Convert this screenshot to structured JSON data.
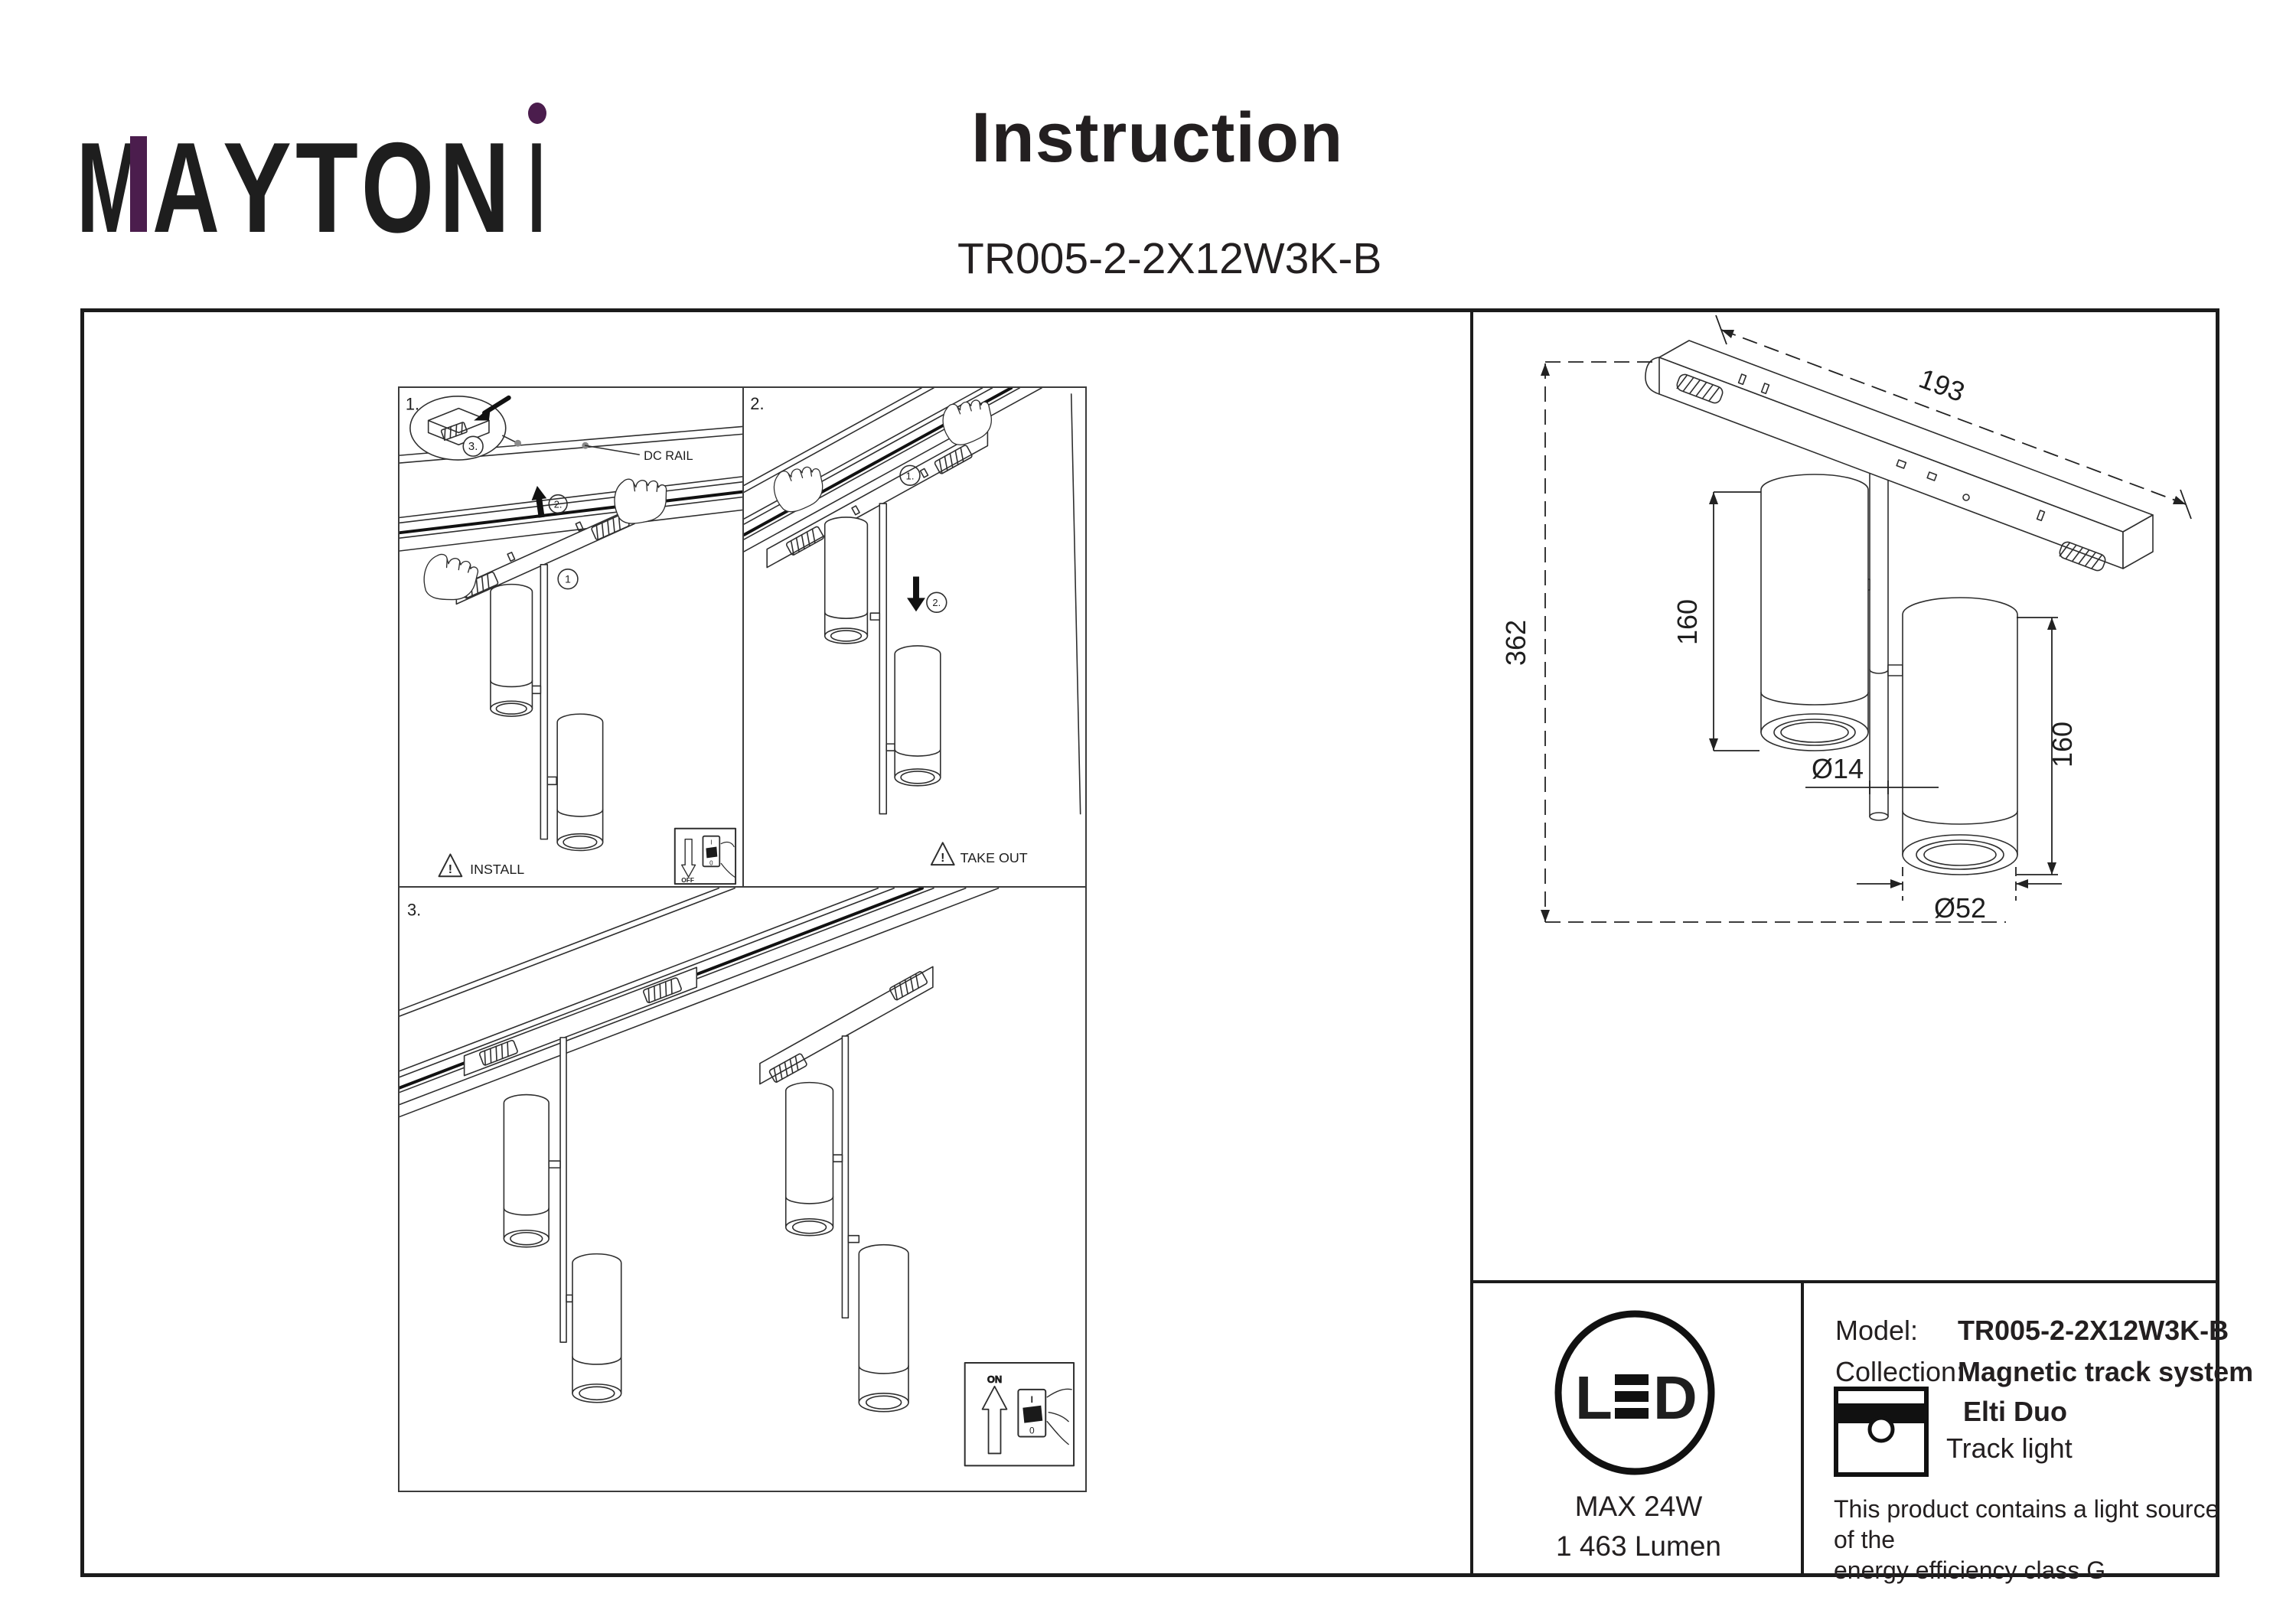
{
  "brand": {
    "letters": [
      "M",
      "A",
      "Y",
      "T",
      "O",
      "N",
      "I"
    ],
    "tagline": "DECORATIVE LIGHTING",
    "accent_color": "#4b1d4d",
    "ink_color": "#231f20"
  },
  "header": {
    "title": "Instruction",
    "model_code": "TR005-2-2X12W3K-B"
  },
  "panels": {
    "p1": {
      "step": "1.",
      "callout_step": "3.",
      "arrow_step": "2.",
      "item_step": "1",
      "rail_label": "DC RAIL",
      "warning_mark": "!",
      "caption": "INSTALL",
      "switch_label": "OFF",
      "switch_on_mark": "I",
      "switch_off_mark": "0"
    },
    "p2": {
      "step": "2.",
      "step1": "1.",
      "step2": "2.",
      "warning_mark": "!",
      "caption": "TAKE OUT"
    },
    "p3": {
      "step": "3.",
      "switch_label": "ON",
      "switch_on_mark": "I",
      "switch_off_mark": "0"
    }
  },
  "dimensions": {
    "track_length": "193",
    "total_height": "362",
    "cylinder1_height": "160",
    "cylinder2_height": "160",
    "stem_diameter": "Ø14",
    "cylinder_diameter": "Ø52"
  },
  "led_badge": {
    "letter_l": "L",
    "letter_d": "D",
    "max_power": "MAX 24W",
    "luminous_flux": "1 463 Lumen"
  },
  "spec": {
    "model_label": "Model:",
    "model_value": "TR005-2-2X12W3K-B",
    "collection_label": "Collection:",
    "collection_value": "Magnetic track system",
    "series": "Elti Duo",
    "type": "Track light",
    "note_line1": "This product contains a light source of the",
    "note_line2": "energy efficiency class G"
  }
}
